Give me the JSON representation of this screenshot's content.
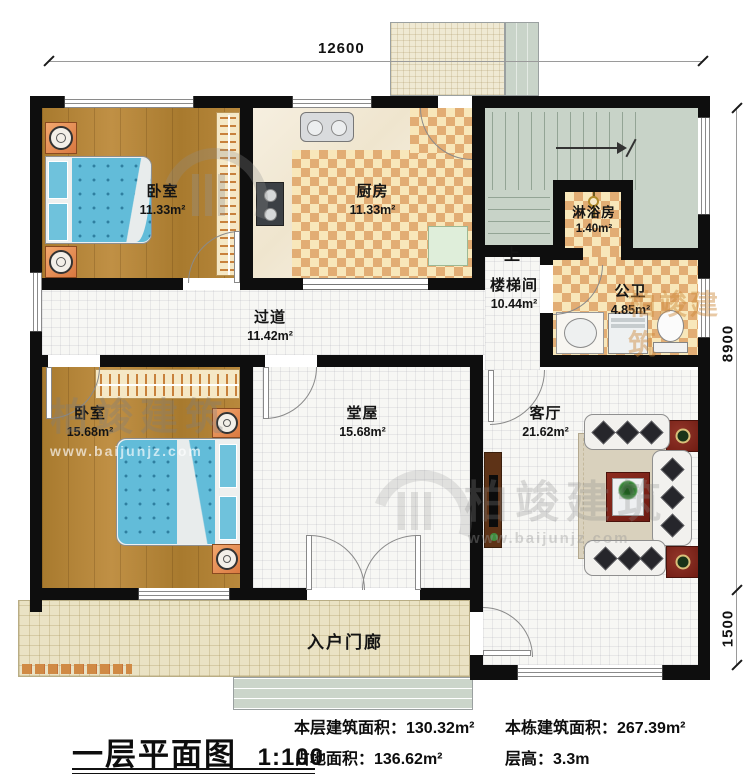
{
  "title": {
    "text": "一层平面图",
    "scale": "1:100"
  },
  "stats": {
    "floor_area": "本层建筑面积：130.32m²",
    "footprint": "占地面积：136.62m²",
    "total_area": "本栋建筑面积：267.39m²",
    "floor_height": "层高：3.3m"
  },
  "dimensions": {
    "top": "12600",
    "right_upper": "8900",
    "right_lower": "1500"
  },
  "rooms": {
    "bedroom1": {
      "label": "卧室",
      "area": "11.33m²"
    },
    "kitchen": {
      "label": "厨房",
      "area": "11.33m²"
    },
    "shower": {
      "label": "淋浴房",
      "area": "1.40m²"
    },
    "stairwell": {
      "label": "楼梯间",
      "area": "10.44m²"
    },
    "bathroom": {
      "label": "公卫",
      "area": "4.85m²"
    },
    "corridor": {
      "label": "过道",
      "area": "11.42m²"
    },
    "bedroom2": {
      "label": "卧室",
      "area": "15.68m²"
    },
    "hall": {
      "label": "堂屋",
      "area": "15.68m²"
    },
    "living": {
      "label": "客厅",
      "area": "21.62m²"
    },
    "porch": {
      "label": "入户门廊"
    }
  },
  "annotations": {
    "stairs_up": "上"
  },
  "watermark": {
    "brand": "柏竣建筑",
    "url": "www.baijunjz.com"
  },
  "colors": {
    "wall": "#0e0e0e",
    "wood": "#b08134",
    "checker": "#e2ad74",
    "sage": "#c8d3c8",
    "porch_tile": "#eae2c4",
    "bed": "#62bcd9"
  }
}
